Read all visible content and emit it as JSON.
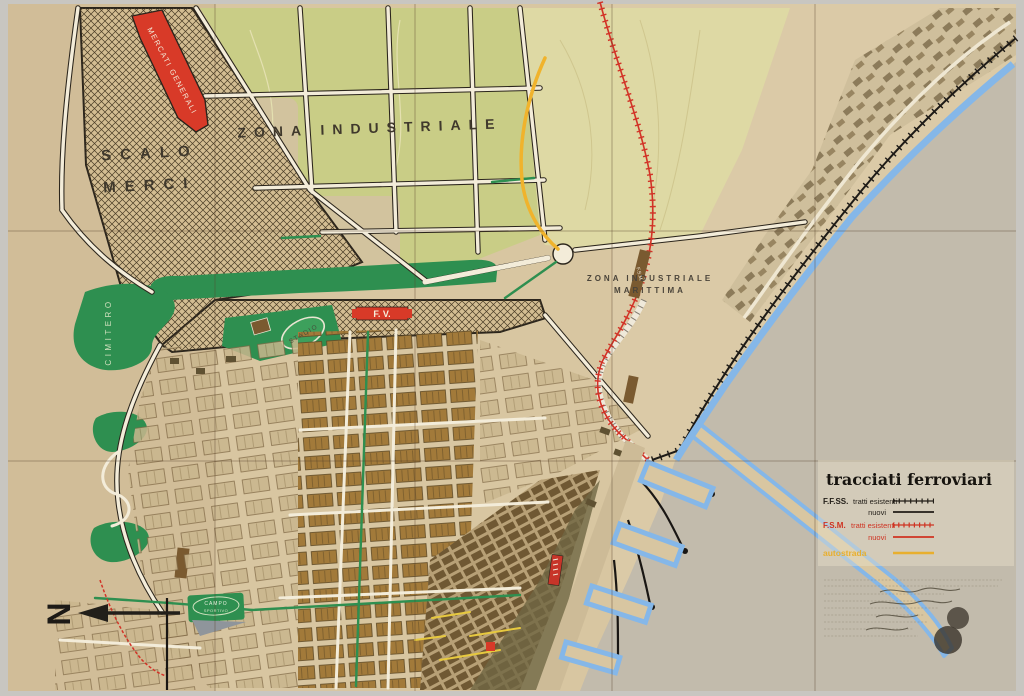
{
  "map": {
    "labels": {
      "scalo_1": "SCALO",
      "scalo_2": "MERCI",
      "mercati_generali": "MERCATI GENERALI",
      "zona_industriale": "ZONA INDUSTRIALE",
      "zim_1": "ZONA INDUSTRIALE",
      "zim_2": "MARITTIMA",
      "fsm_strip": "F.S.M.",
      "cimitero": "CIMITERO",
      "stadio": "STADIO",
      "fv": "F. V.",
      "campo_1": "CAMPO",
      "campo_2": "SPORTIVO",
      "north": "N"
    },
    "legend": {
      "title": "tracciati ferroviari",
      "rows": [
        {
          "prefix": "F.F.SS.",
          "label": "tratti esistenti",
          "style": "black-hatched"
        },
        {
          "prefix": "",
          "label": "nuovi",
          "style": "black-solid"
        },
        {
          "prefix": "F.S.M.",
          "label": "tratti esistenti",
          "style": "red-hatched"
        },
        {
          "prefix": "",
          "label": "nuovi",
          "style": "red-solid"
        },
        {
          "prefix": "",
          "label": "autostrada",
          "style": "yellow-solid"
        }
      ]
    },
    "colors": {
      "paper": "#d8c6a1",
      "sea": "#c2bbac",
      "water_blue": "#85b7e8",
      "park_green": "#2e8f50",
      "industrial_green": "#c9cd86",
      "pale_yellow": "#ded9a4",
      "accent_red": "#d83a28",
      "rail_black": "#1e1b17",
      "autostrada_yellow": "#f0b32c"
    }
  }
}
